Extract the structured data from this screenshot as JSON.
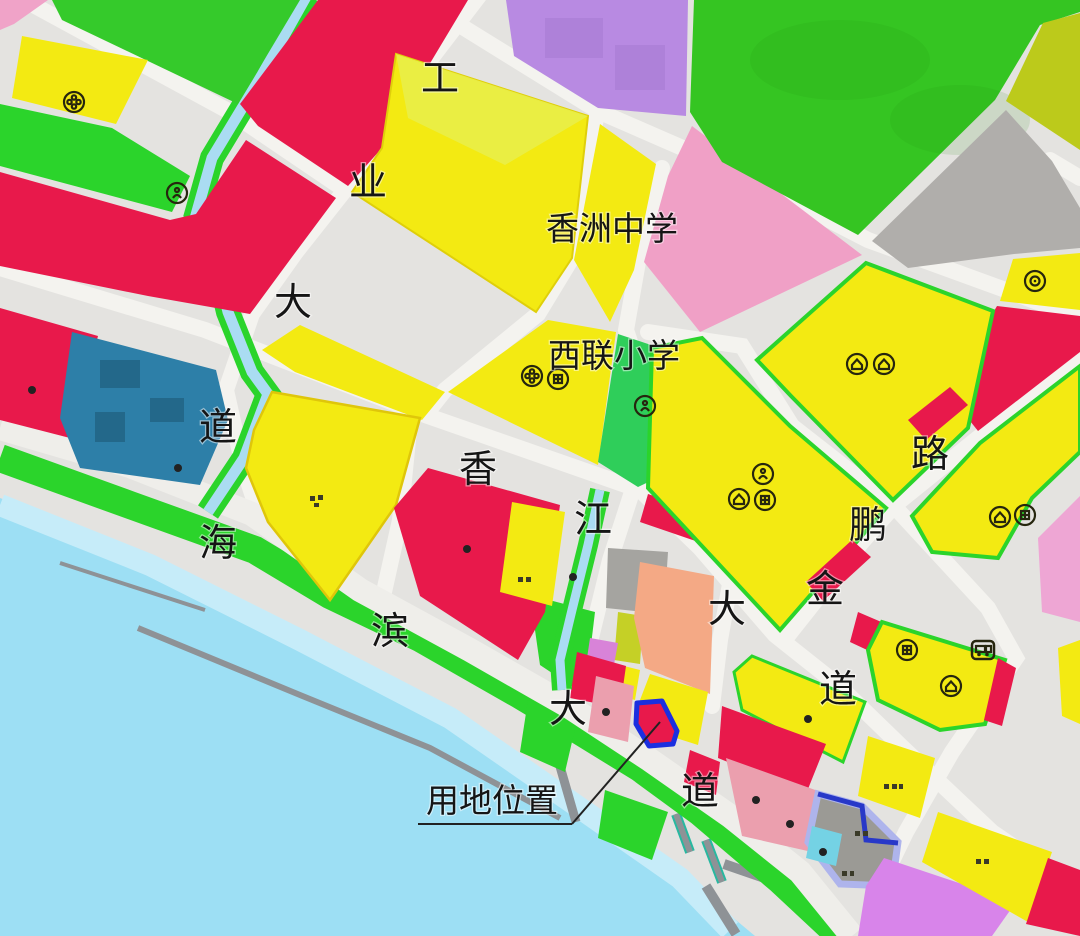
{
  "map": {
    "roads": {
      "industrial_avenue": {
        "name": "工业大道",
        "chars": [
          "工",
          "业",
          "大",
          "道"
        ]
      },
      "xiangjiang_avenue": {
        "name": "香江大道",
        "chars": [
          "香",
          "江",
          "大",
          "道"
        ]
      },
      "haibin_avenue": {
        "name": "海滨大道",
        "chars": [
          "海",
          "滨",
          "大",
          "道"
        ]
      },
      "jinpeng_road": {
        "name": "金鹏路",
        "chars": [
          "金",
          "鹏",
          "路"
        ]
      }
    },
    "schools": {
      "middle_school": "香洲中学",
      "primary_school": "西联小学"
    },
    "site": {
      "label": "用地位置",
      "outline_color": "#1b2fe0",
      "fill_color": "#e8194b"
    },
    "palette": {
      "road": "#e4e3e0",
      "residential_yellow": "#f3ea12",
      "commercial_red": "#e8194b",
      "green_space": "#2bd42b",
      "school_green": "#2fce5a",
      "forest": "#35c522",
      "water": "#9ddff4",
      "canal": "#aadcf2",
      "pink": "#f0a0c6",
      "rose": "#eb9fae",
      "violet": "#b88ae2",
      "magenta": "#d884ea",
      "orange": "#f4a985",
      "olive": "#bcca1b",
      "teal": "#2d7fa8",
      "gray_block": "#b0aeab"
    }
  }
}
